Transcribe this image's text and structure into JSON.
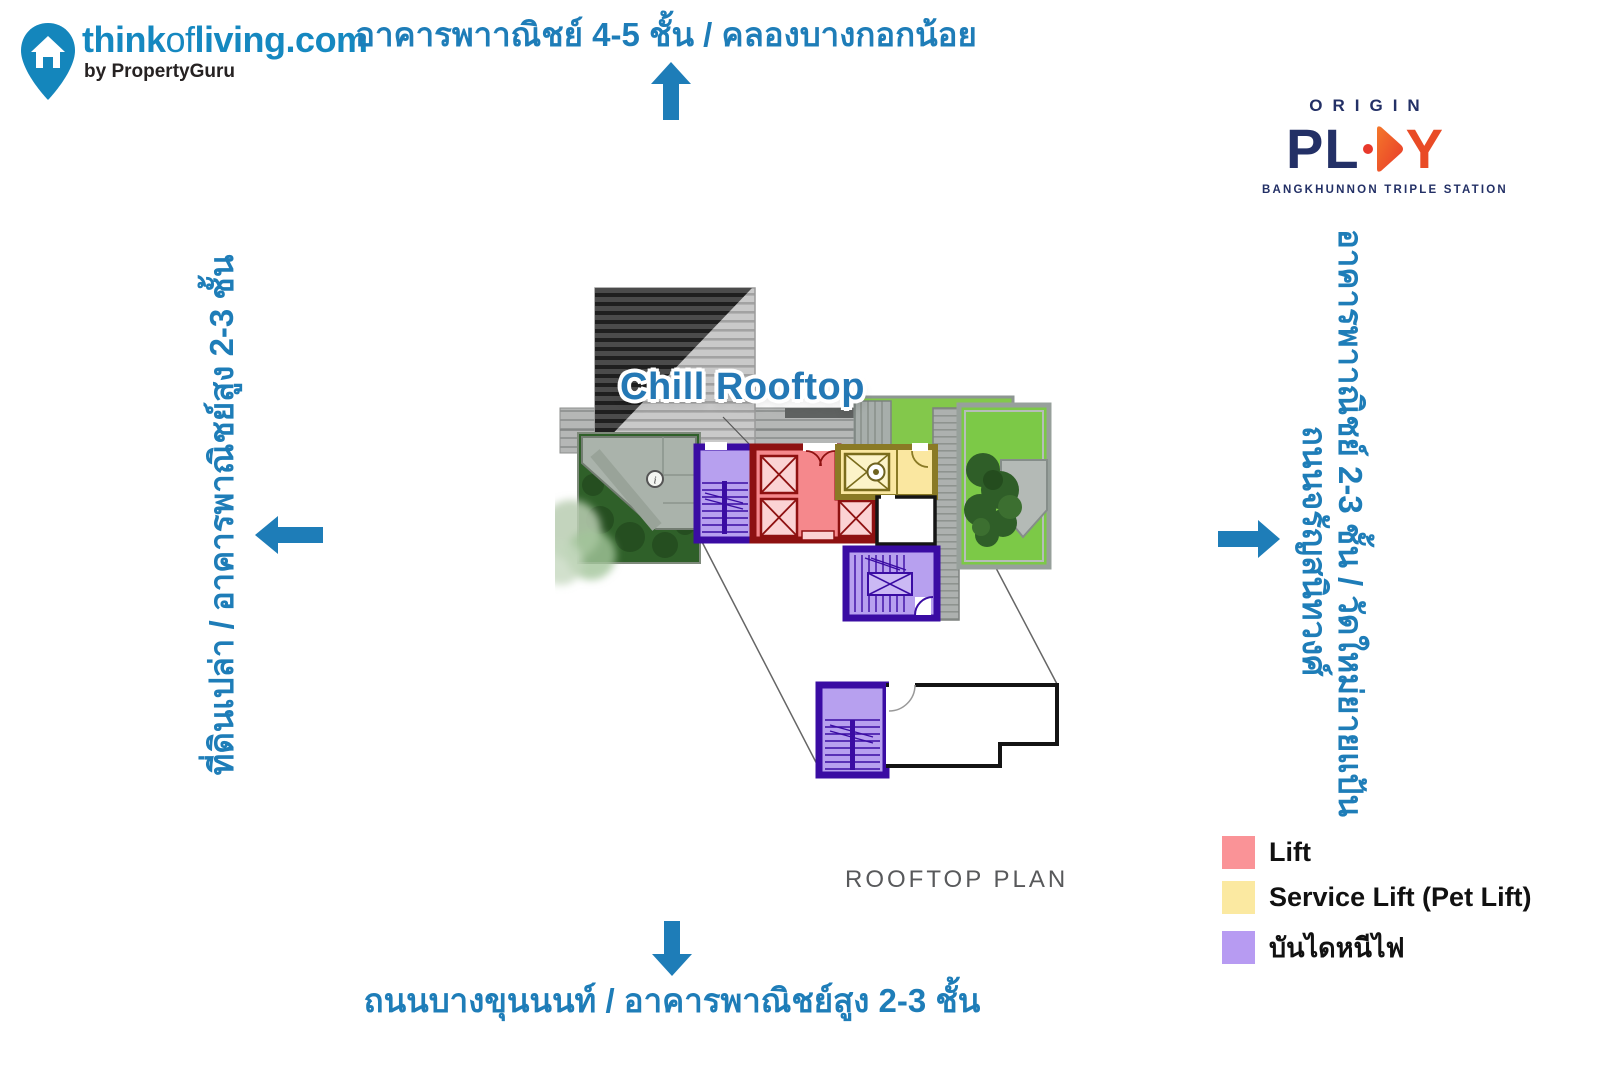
{
  "branding": {
    "site_bold1": "think",
    "site_light": "of",
    "site_bold2": "living.com",
    "byline": "by PropertyGuru"
  },
  "project": {
    "name_top": "ORIGIN",
    "name_pl": "PL",
    "name_y": "Y",
    "subtitle": "BANGKHUNNON TRIPLE STATION"
  },
  "surroundings": {
    "north": "อาคารพาาณิชย์ 4-5 ชั้น / คลองบางกอกน้อย",
    "south": "ถนนบางขุนนนท์ / อาคารพาณิชย์สูง 2-3 ชั้น",
    "west": "ที่ดินเปล่า / อาคารพาณิชย์สูง 2-3 ชั้น",
    "east_line1": "อาคารพาาณิชย์ 2-3 ชั้น / วัดใหม่ยายแป้น",
    "east_line2": "ถนนจรัญสนิทวงศ์"
  },
  "plan": {
    "label": "Chill Rooftop",
    "caption": "ROOFTOP PLAN",
    "info_marker": "i"
  },
  "legend": {
    "items": [
      {
        "label": "Lift",
        "color": "#FA9397"
      },
      {
        "label": "Service Lift (Pet Lift)",
        "color": "#FBE9A1"
      },
      {
        "label": "บันไดหนีไฟ",
        "color": "#B79BF2"
      }
    ]
  },
  "colors": {
    "accent_blue": "#1E7DB8",
    "plan_label_blue": "#2478B5",
    "brand_blue": "#1588C0",
    "navy": "#233066",
    "orange": "#ED5A26",
    "stair_purple_border": "#3A0CA3",
    "lift_red_border": "#8E1111",
    "service_yellow_border": "#8A7A25"
  }
}
